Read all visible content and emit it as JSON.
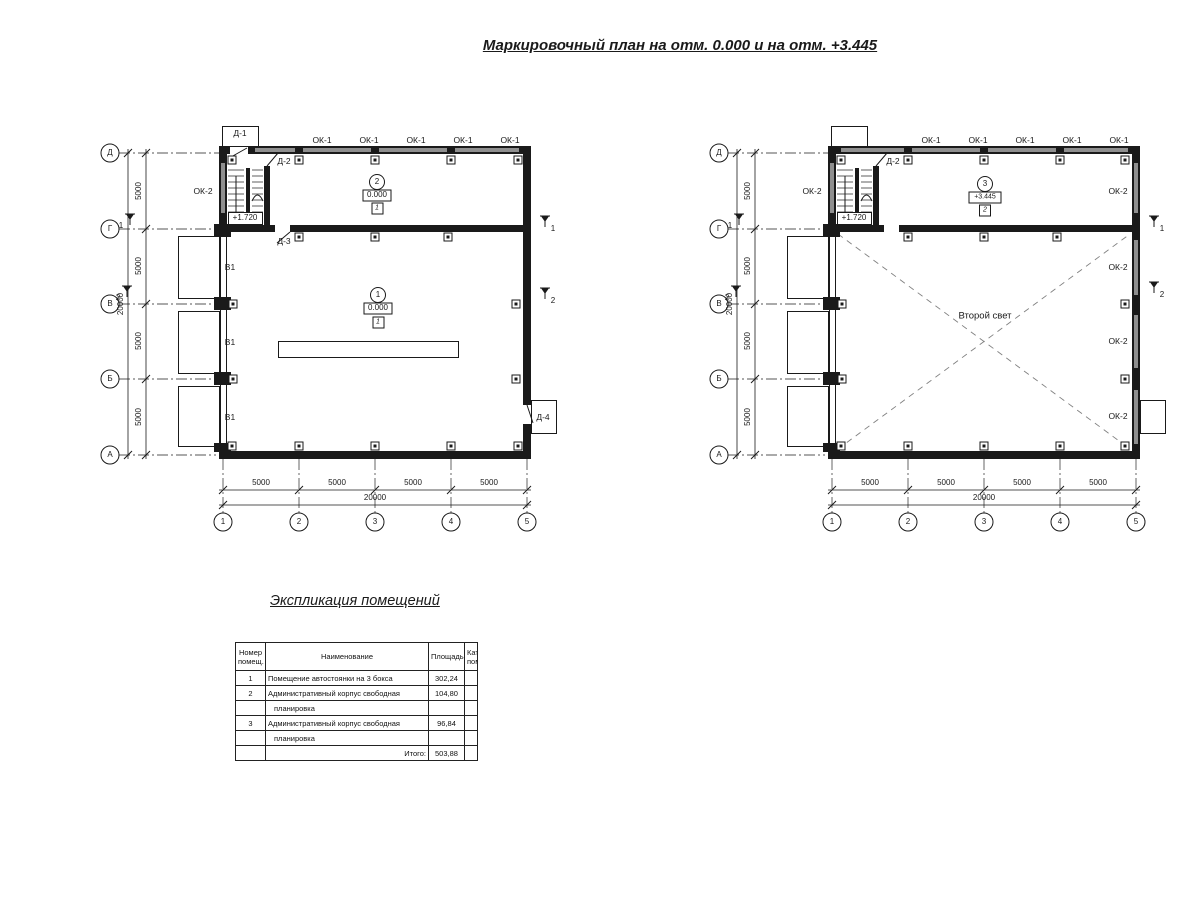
{
  "title": "Маркировочный план на отм. 0.000 и на отм. +3.445",
  "labels": {
    "ok1": "ОК-1",
    "ok2": "ОК-2",
    "v1": "В1",
    "d1": "Д-1",
    "d2": "Д-2",
    "d3": "Д-3",
    "d4": "Д-4",
    "stair_level": "+1.720",
    "second_light": "Второй свет"
  },
  "axes": {
    "rows": [
      "Д",
      "Г",
      "В",
      "Б",
      "А"
    ],
    "cols": [
      "1",
      "2",
      "3",
      "4",
      "5"
    ]
  },
  "dims": {
    "bay": "5000",
    "total": "20000"
  },
  "rooms": {
    "r1": {
      "num": "1",
      "elev": "0.000",
      "cat": "1"
    },
    "r2": {
      "num": "2",
      "elev": "0.000",
      "cat": "1"
    },
    "r3": {
      "num": "3",
      "elev": "+3.445",
      "cat": "2"
    }
  },
  "sections": [
    "1",
    "2"
  ],
  "explication": {
    "title": "Экспликация помещений",
    "col_num_1": "Номер",
    "col_num_2": "помещ.",
    "col_name": "Наименование",
    "col_area": "Площадь",
    "col_cat_1": "Кат.",
    "col_cat_2": "пом.",
    "rows": [
      {
        "num": "1",
        "name": "Помещение автостоянки на 3 бокса",
        "area": "302,24"
      },
      {
        "num": "2",
        "name": "Административный корпус свободная",
        "area": "104,80"
      },
      {
        "num": "",
        "name": "планировка",
        "area": ""
      },
      {
        "num": "3",
        "name": "Административный корпус свободная",
        "area": "96,84"
      },
      {
        "num": "",
        "name": "планировка",
        "area": ""
      }
    ],
    "total_label": "Итого:",
    "total_value": "503,88"
  }
}
